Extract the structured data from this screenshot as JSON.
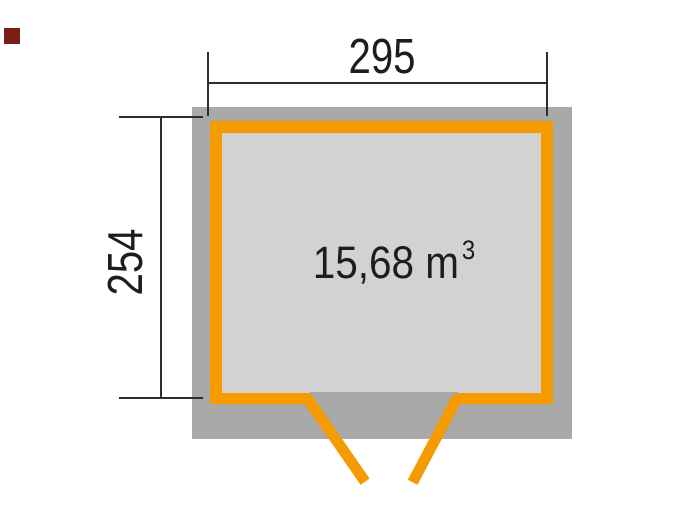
{
  "theme": {
    "page-bg": "#ffffff",
    "wall": "#a9a9a9",
    "interior": "#d2d2d2",
    "outline": "#f59b00",
    "line": "#2d2d2d",
    "ink": "#1d1d1b",
    "brand": "#7c1e15"
  },
  "floorplan": {
    "area": {
      "text": "15,68 m",
      "exponent": "3"
    },
    "dimensions": {
      "width": "295",
      "depth": "254"
    }
  }
}
